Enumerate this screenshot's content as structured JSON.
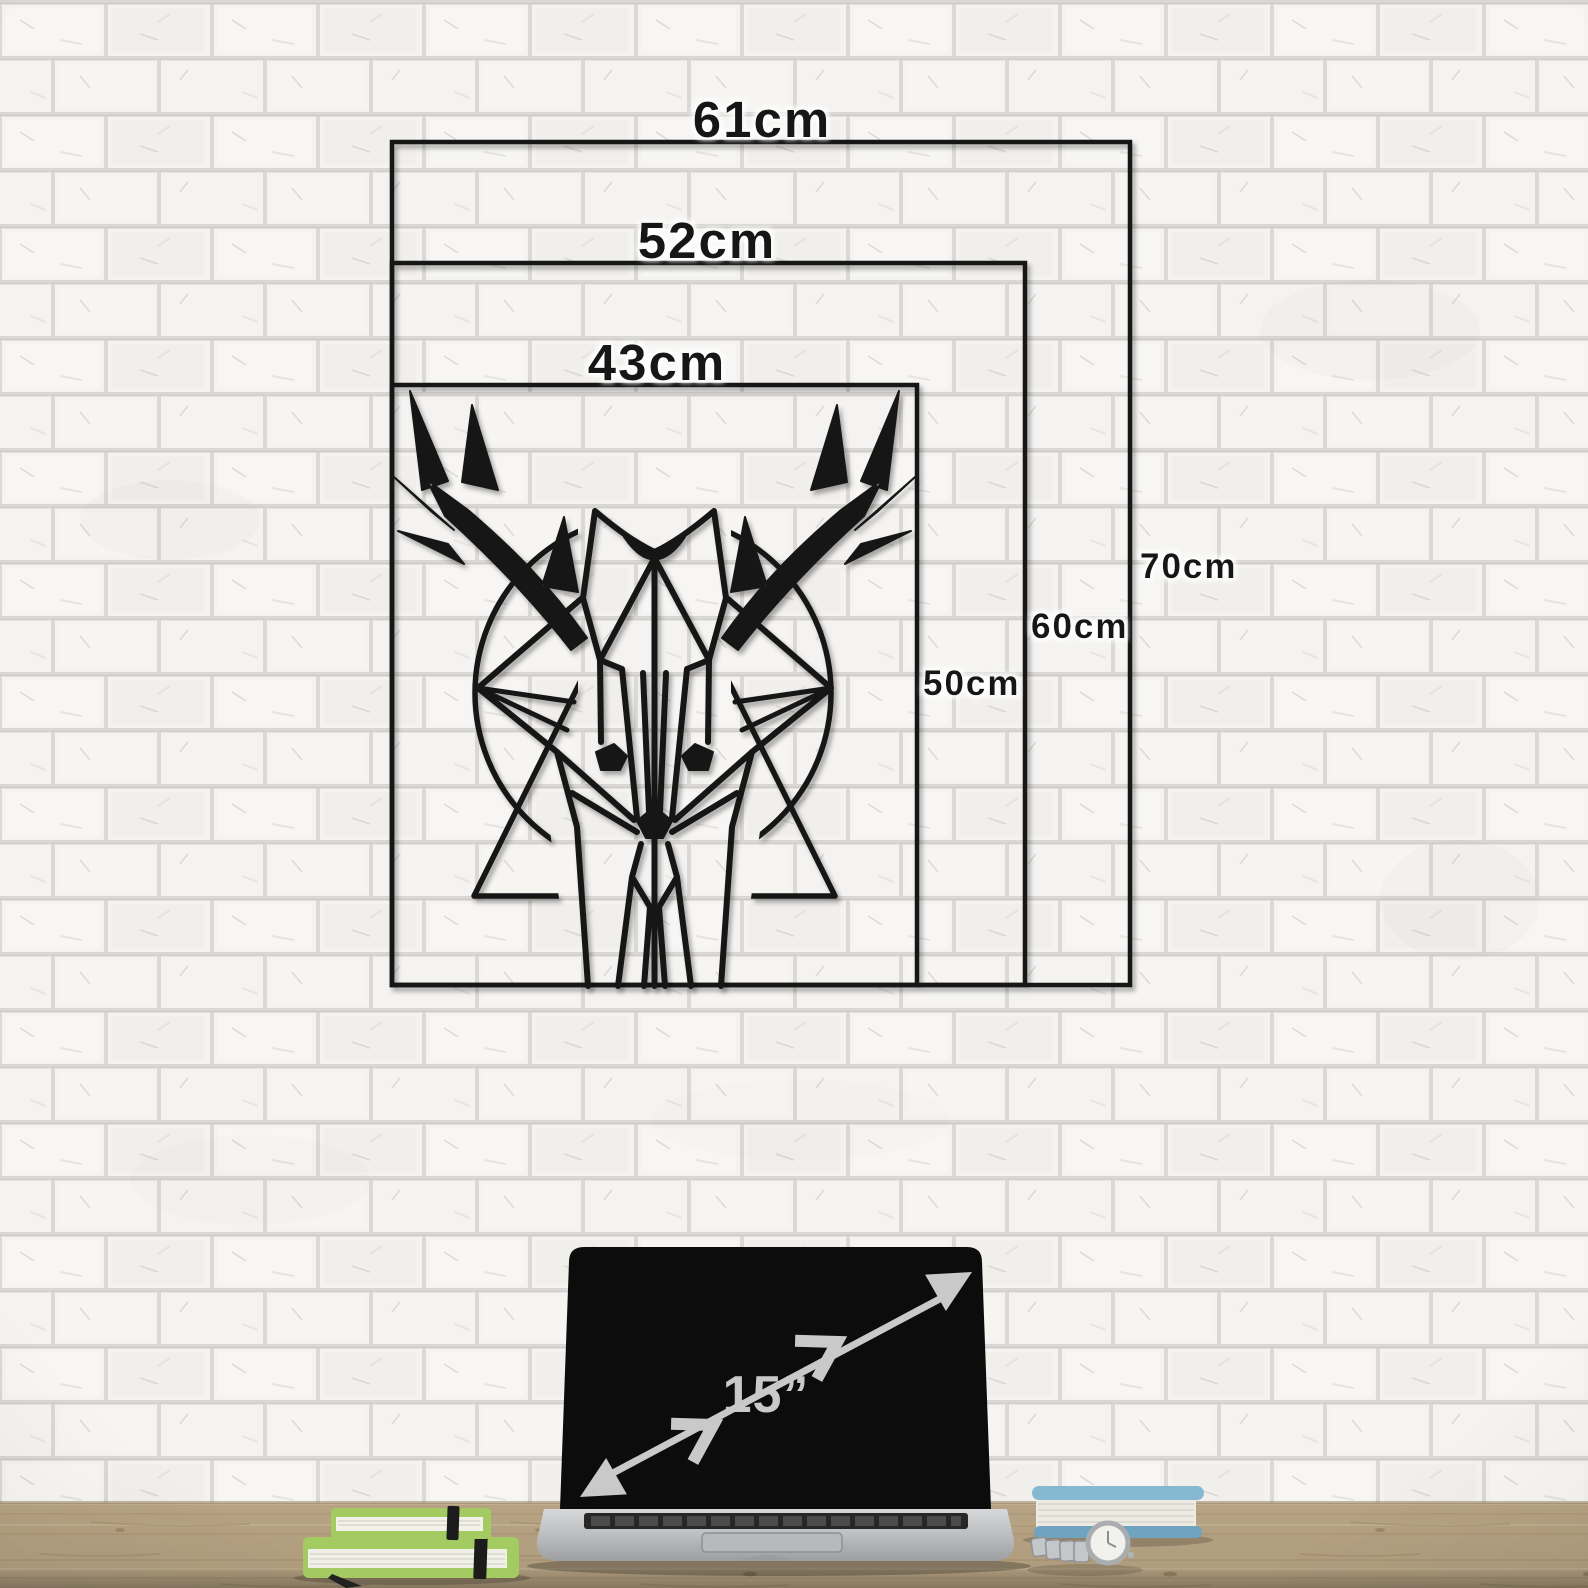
{
  "size_diagram": {
    "sizes": [
      {
        "width_label": "43cm",
        "height_label": "50cm"
      },
      {
        "width_label": "52cm",
        "height_label": "60cm"
      },
      {
        "width_label": "61cm",
        "height_label": "70cm"
      }
    ]
  },
  "scale_reference": {
    "laptop_diagonal_label": "15”"
  },
  "colors": {
    "outline_black": "#171717",
    "label_text": "#121212",
    "wall_brick": "#f4f3f1",
    "wall_mortar": "#dad8d4",
    "desk_wood": "#c3ae8c",
    "laptop_screen": "#0c0c0c",
    "laptop_body_light": "#d5d6d8",
    "laptop_body_dark": "#a4a5a7",
    "arrow_gray": "#c9c9c9",
    "notebook_green": "#a3cb62",
    "book_blue": "#86b8d2"
  }
}
